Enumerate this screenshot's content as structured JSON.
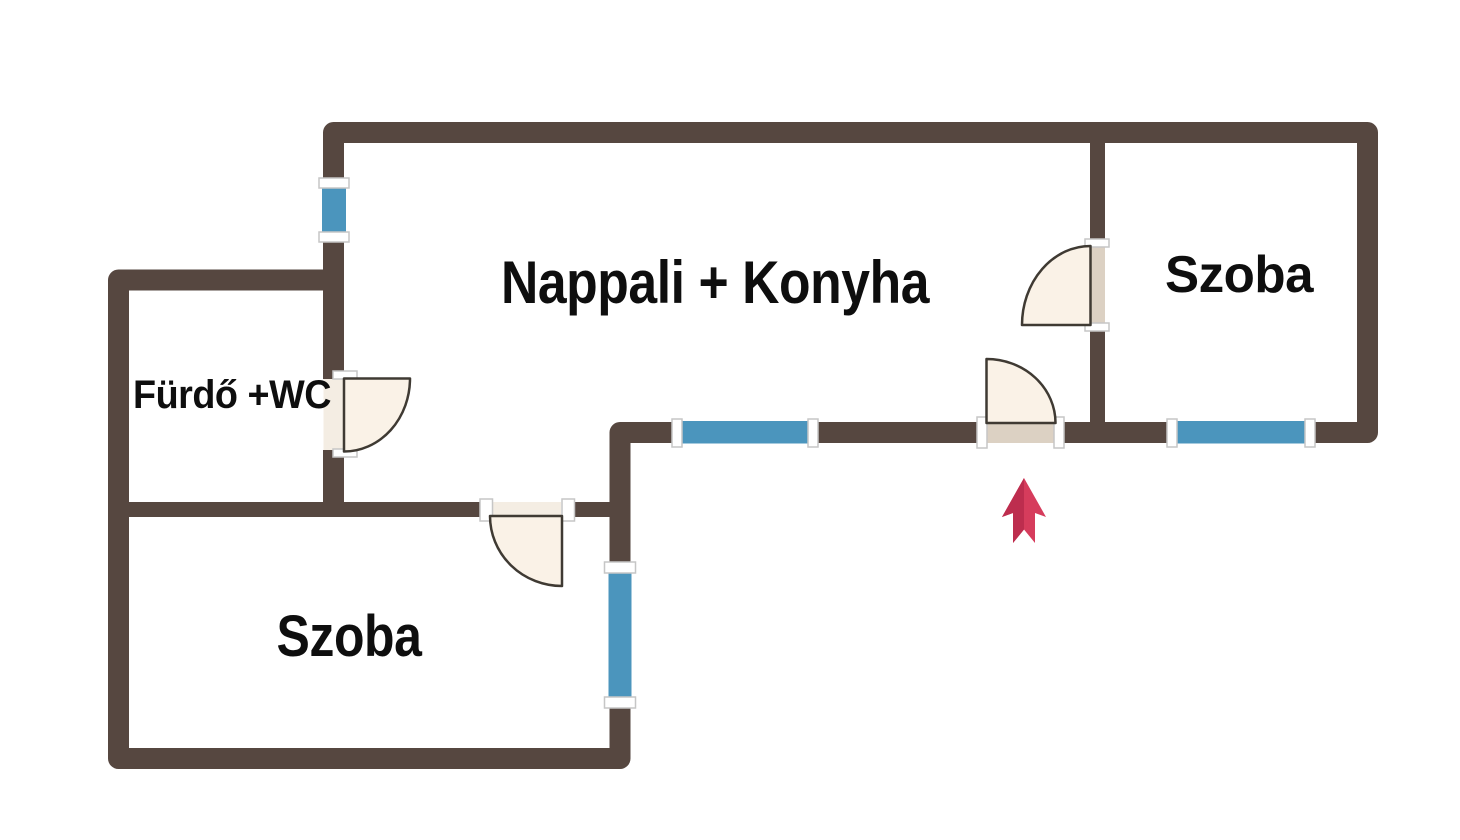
{
  "image_type": "floor-plan",
  "rooms": [
    {
      "label": "Nappali + Konyha"
    },
    {
      "label": "Fürdő +WC"
    },
    {
      "label": "Szoba"
    },
    {
      "label": "Szoba"
    }
  ],
  "features": {
    "entrance_arrow_direction": "up",
    "door_count": 4,
    "window_count": 4
  },
  "colors": {
    "background": "#ffffff",
    "wall": "#564740",
    "window": "#4b95bd",
    "frame": "#ffffff",
    "frame_stroke": "#c6c6c6",
    "door_fill": "#faf2e7",
    "door_outline": "#3f3a33",
    "door_leaf": "#dcd1c3",
    "sill": "#f4ede3",
    "arrow": "#d63c5c",
    "arrow_dark": "#bd2d4e",
    "text": "#0e0e0e"
  }
}
